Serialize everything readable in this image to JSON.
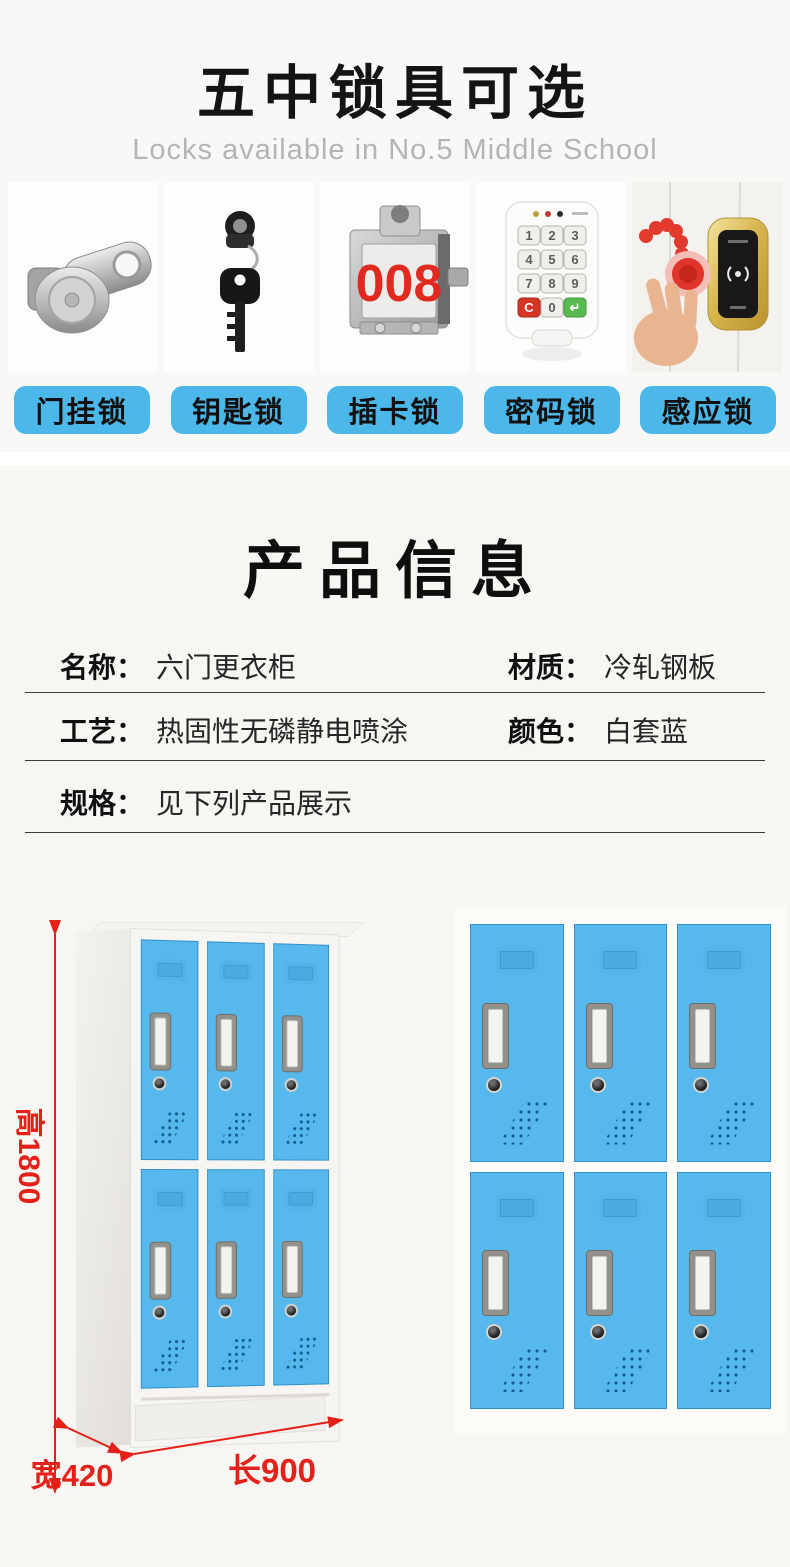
{
  "header": {
    "title": "五中锁具可选",
    "subtitle": "Locks available in No.5 Middle School"
  },
  "lock_types": [
    {
      "label": "门挂锁"
    },
    {
      "label": "钥匙锁"
    },
    {
      "label": "插卡锁"
    },
    {
      "label": "密码锁"
    },
    {
      "label": "感应锁"
    }
  ],
  "photos": {
    "card_lock_display": "008",
    "keypad_keys": [
      "1",
      "2",
      "3",
      "4",
      "5",
      "6",
      "7",
      "8",
      "9",
      "C",
      "0",
      "↵"
    ]
  },
  "product_info": {
    "title": "产品信息",
    "rows": [
      {
        "label": "名称：",
        "value": "六门更衣柜"
      },
      {
        "label": "材质：",
        "value": "冷轧钢板"
      },
      {
        "label": "工艺：",
        "value": "热固性无磷静电喷涂"
      },
      {
        "label": "颜色：",
        "value": "白套蓝"
      },
      {
        "label": "规格：",
        "value": "见下列产品展示"
      }
    ]
  },
  "dimensions": {
    "height_label": "高1800",
    "width_label": "宽420",
    "length_label": "长900"
  },
  "colors": {
    "button_blue": "#4cb8ea",
    "door_blue": "#56b8ec",
    "dimension_red": "#e32119",
    "display_red": "#e02a20"
  }
}
